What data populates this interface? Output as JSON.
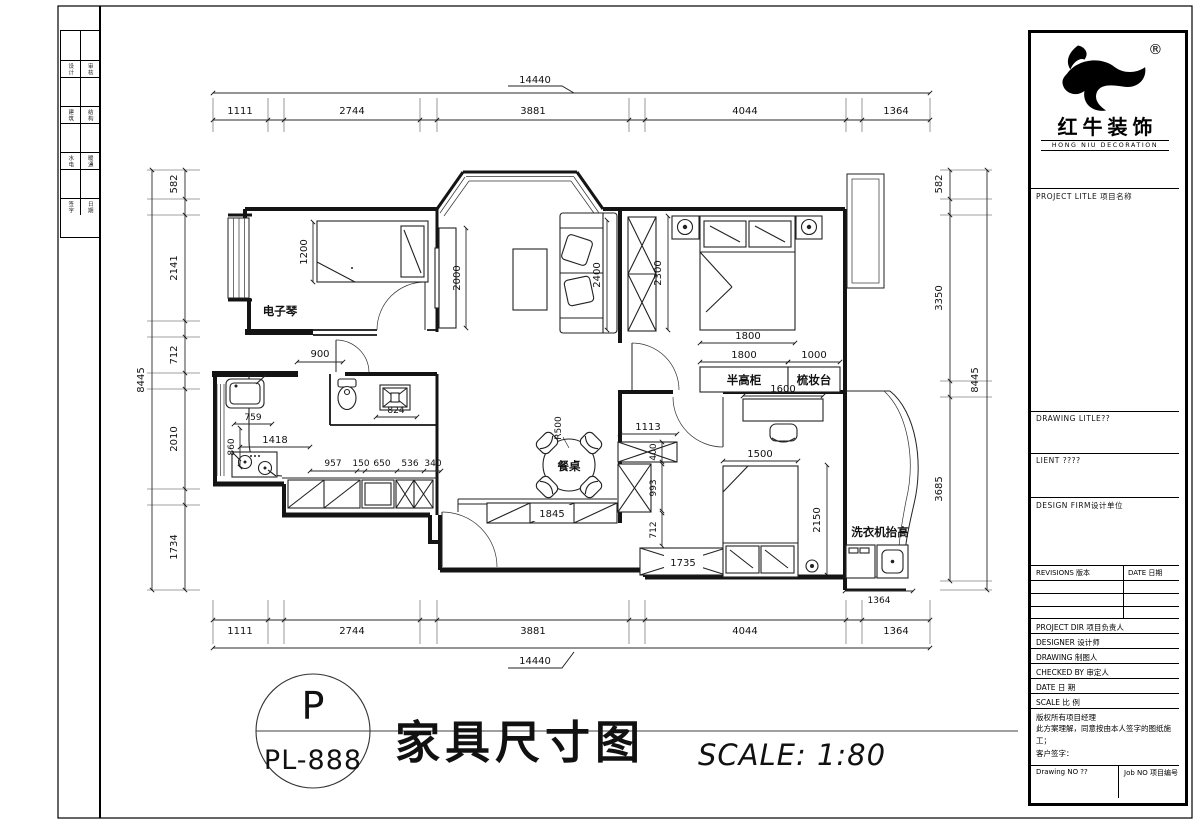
{
  "sheet": {
    "stamp": {
      "letter": "P",
      "code": "PL-888"
    },
    "title": "家具尺寸图",
    "scale_note": "SCALE:  1:80"
  },
  "brand": {
    "name": "红牛装饰",
    "name_en": "HONG NIU DECORATION",
    "reg": "®"
  },
  "titleblock": {
    "project_title": "PROJECT LITLE  项目名称",
    "drawing_title": "DRAWING  LITLE??",
    "client": "LIENT ????",
    "design_firm": "DESIGN  FIRM设计单位",
    "revisions": "REVISIONS  版本",
    "date_col": "DATE  日期",
    "rows": [
      "PROJECT DIR    项目负责人",
      "DESIGNER       设计师",
      "DRAWING        制图人",
      "CHECKED BY     审定人",
      "DATE           日 期",
      "SCALE          比 例"
    ],
    "copyright1": "版权所有项目经理",
    "copyright2": "此方案理解，同意按由本人签字的图纸施工；",
    "signature": "客户签字：",
    "drawing_no": "Drawing NO ??",
    "job_no": "Job NO 项目编号"
  },
  "strip": {
    "rows": [
      [
        "设计",
        "审核"
      ],
      [
        "建筑",
        "结构"
      ],
      [
        "水电",
        "暖通"
      ],
      [
        "签字",
        "日期"
      ]
    ]
  },
  "labels": {
    "piano": "电子琴",
    "dining": "餐桌",
    "radius": "R500",
    "half_cabinet": "半高柜",
    "dresser": "梳妆台",
    "washer": "洗衣机抬高"
  },
  "dims": {
    "top": {
      "overall": "14440",
      "segs": [
        "1111",
        "2744",
        "3881",
        "4044",
        "1364"
      ]
    },
    "bottom": {
      "overall": "14440",
      "segs": [
        "1111",
        "2744",
        "3881",
        "4044",
        "1364"
      ],
      "balcony": "1364"
    },
    "left": {
      "overall": "8445",
      "segs": [
        "582",
        "2141",
        "712",
        "2010",
        "1734"
      ]
    },
    "right": {
      "overall": "8445",
      "segs": [
        "582",
        "3350",
        "3685"
      ]
    },
    "interior": {
      "bed2_w": "1200",
      "tv_len": "2000",
      "door_kitchen": "900",
      "sofa_len": "2400",
      "wardrobe1": "2300",
      "bed1_w": "1800",
      "cab1": "1800",
      "cab2": "1000",
      "desk": "1600",
      "k1": "759",
      "k2": "860",
      "k3": "1418",
      "shower": "824",
      "c1": "957",
      "c2": "150",
      "c3": "650",
      "c4": "536",
      "c5": "340",
      "shoe": "1845",
      "h1": "1113",
      "h2": "400",
      "h3": "993",
      "h4": "712",
      "h5": "1735",
      "bed3_w": "1500",
      "bed3_l": "2150"
    }
  }
}
